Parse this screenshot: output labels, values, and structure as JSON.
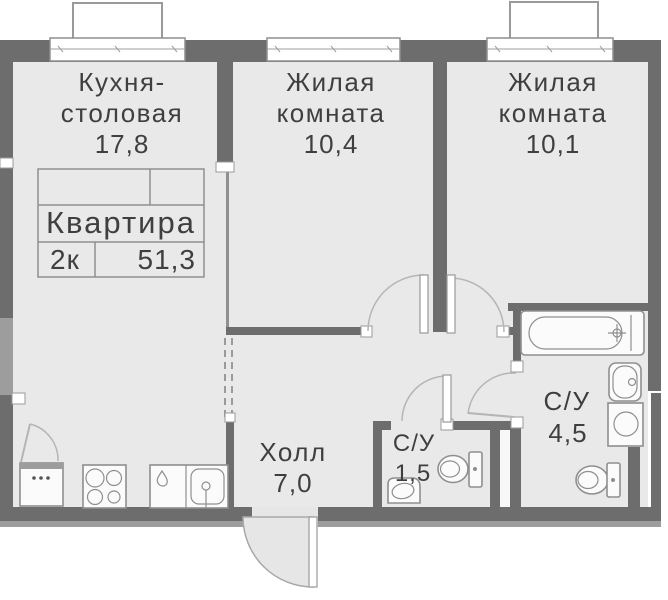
{
  "floorplan": {
    "info_table": {
      "title": "Квартира",
      "rooms_count": "2к",
      "total_area": "51,3"
    },
    "rooms": {
      "kitchen": {
        "line1": "Кухня-",
        "line2": "столовая",
        "area": "17,8"
      },
      "living1": {
        "line1": "Жилая",
        "line2": "комната",
        "area": "10,4"
      },
      "living2": {
        "line1": "Жилая",
        "line2": "комната",
        "area": "10,1"
      },
      "hall": {
        "name": "Холл",
        "area": "7,0"
      },
      "bathroom_small": {
        "name": "С/У",
        "area": "1,5"
      },
      "bathroom_large": {
        "name": "С/У",
        "area": "4,5"
      }
    },
    "colors": {
      "wall": "#6d6d6d",
      "wall_light": "#9d9d9d",
      "floor": "#e9e9e9",
      "fixture_stroke": "#8f8f8f",
      "door_arc": "#b5b5b5",
      "text": "#3f3f3f",
      "background": "#ffffff"
    }
  }
}
